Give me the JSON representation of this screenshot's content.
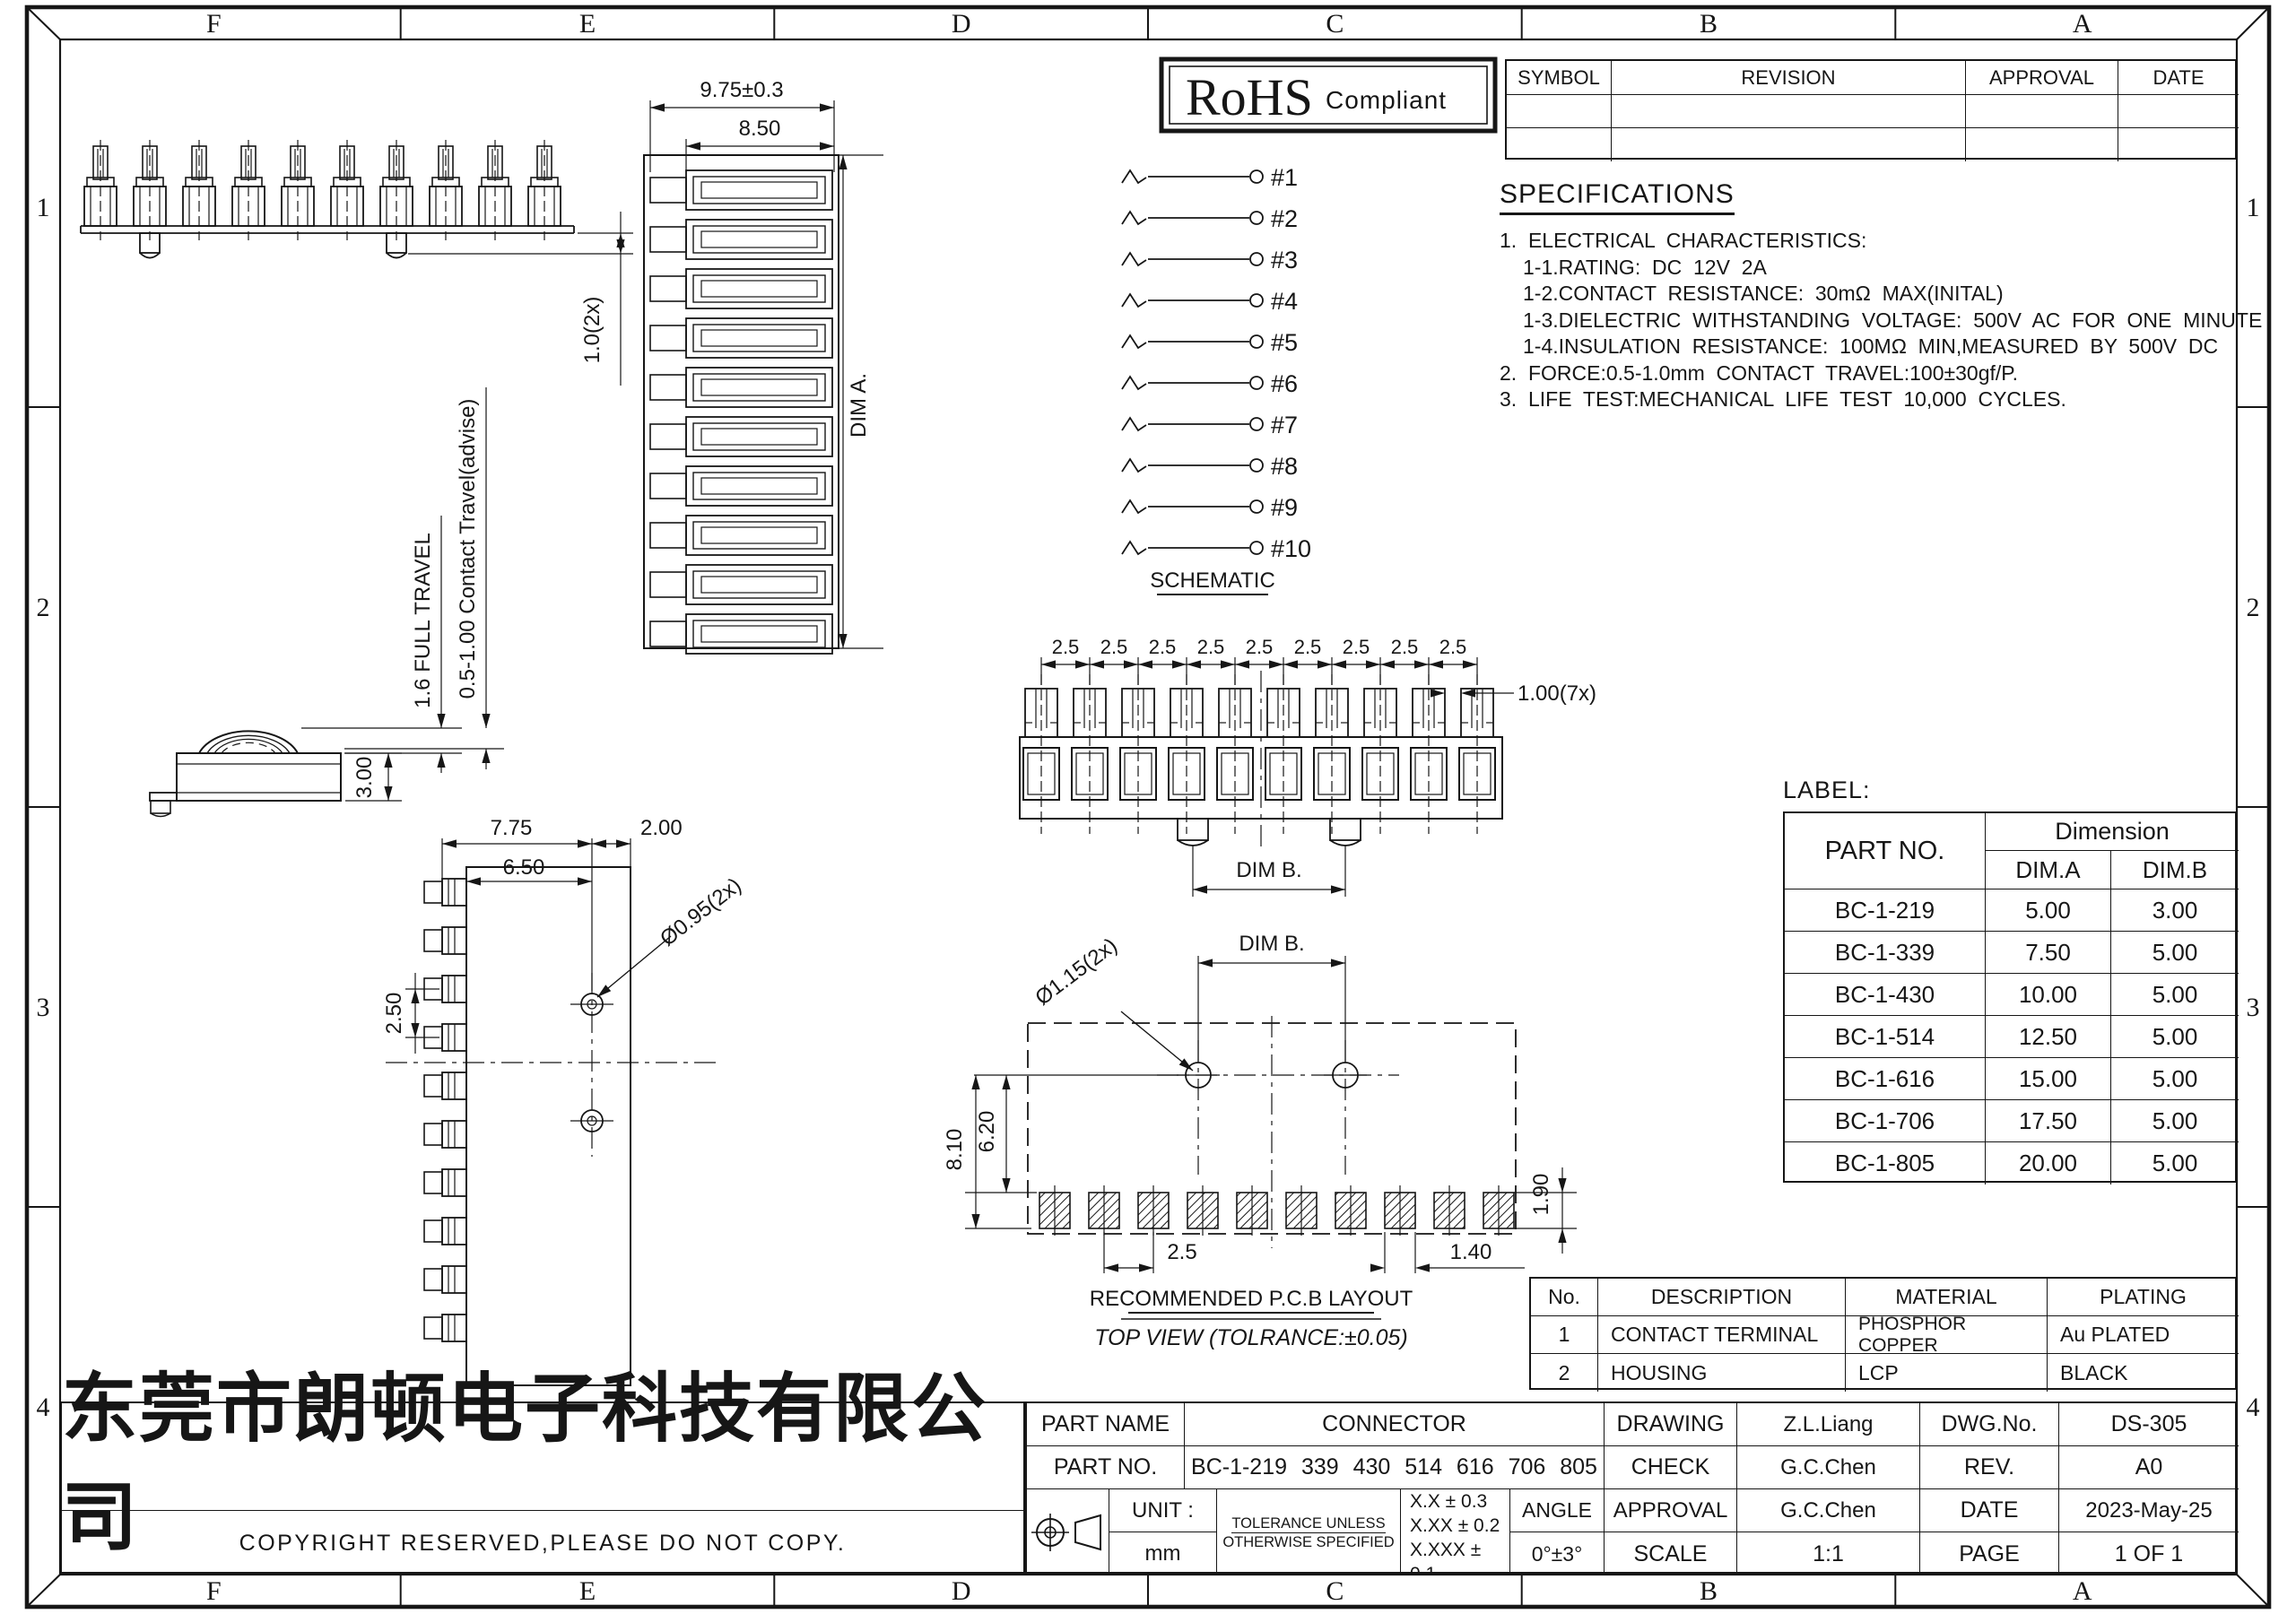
{
  "border": {
    "columns": [
      "F",
      "E",
      "D",
      "C",
      "B",
      "A"
    ],
    "rows": [
      "1",
      "2",
      "3",
      "4"
    ]
  },
  "rohs": {
    "title": "RoHS",
    "subtitle": "Compliant"
  },
  "revision_table": {
    "headers": [
      "SYMBOL",
      "REVISION",
      "APPROVAL",
      "DATE"
    ]
  },
  "specifications": {
    "title": "SPECIFICATIONS",
    "lines": [
      {
        "text": "1.  ELECTRICAL  CHARACTERISTICS:",
        "indent": 0
      },
      {
        "text": "1-1.RATING:  DC  12V  2A",
        "indent": 1
      },
      {
        "text": "1-2.CONTACT  RESISTANCE:  30mΩ  MAX(INITAL)",
        "indent": 1
      },
      {
        "text": "1-3.DIELECTRIC  WITHSTANDING  VOLTAGE:  500V  AC  FOR  ONE  MINUTE",
        "indent": 1
      },
      {
        "text": "1-4.INSULATION  RESISTANCE:  100MΩ  MIN,MEASURED  BY  500V  DC",
        "indent": 1
      },
      {
        "text": "2.  FORCE:0.5-1.0mm  CONTACT  TRAVEL:100±30gf/P.",
        "indent": 0
      },
      {
        "text": "3.  LIFE  TEST:MECHANICAL  LIFE  TEST  10,000  CYCLES.",
        "indent": 0
      }
    ]
  },
  "schematic": {
    "caption": "SCHEMATIC",
    "pins": [
      "#1",
      "#2",
      "#3",
      "#4",
      "#5",
      "#6",
      "#7",
      "#8",
      "#9",
      "#10"
    ]
  },
  "views": {
    "front_row": {
      "dim_travel": "1.0(2x)"
    },
    "side_contact": {
      "dim_full_travel": "1.6 FULL TRAVEL",
      "dim_contact_travel": "0.5-1.00 Contact Travel(advise)",
      "dim_height": "3.00"
    },
    "top_view_left": {
      "dim_width": "7.75",
      "dim_width2": "6.50",
      "dim_right": "2.00",
      "dim_pitch": "2.50",
      "dim_hole": "Ø0.95(2x)"
    },
    "front_view_vertical": {
      "dim_w1": "9.75±0.3",
      "dim_w2": "8.50",
      "dim_a": "DIM A."
    },
    "front_view_center": {
      "pitch": "2.5",
      "dim_gap": "1.00(7x)",
      "dim_b": "DIM B."
    },
    "pcb_layout": {
      "dim_b": "DIM B.",
      "dim_hole": "Ø1.15(2x)",
      "dim_h1": "6.20",
      "dim_h2": "8.10",
      "dim_pad_h": "1.90",
      "dim_pitch": "2.5",
      "dim_pad_w": "1.40",
      "caption1": "RECOMMENDED P.C.B LAYOUT",
      "caption2": "TOP VIEW  (TOLRANCE:±0.05)"
    }
  },
  "label_table": {
    "title": "LABEL:",
    "part_no_header": "PART  NO.",
    "dimension_header": "Dimension",
    "dim_a_header": "DIM.A",
    "dim_b_header": "DIM.B",
    "rows": [
      [
        "BC-1-219",
        "5.00",
        "3.00"
      ],
      [
        "BC-1-339",
        "7.50",
        "5.00"
      ],
      [
        "BC-1-430",
        "10.00",
        "5.00"
      ],
      [
        "BC-1-514",
        "12.50",
        "5.00"
      ],
      [
        "BC-1-616",
        "15.00",
        "5.00"
      ],
      [
        "BC-1-706",
        "17.50",
        "5.00"
      ],
      [
        "BC-1-805",
        "20.00",
        "5.00"
      ]
    ]
  },
  "parts_table": {
    "headers": [
      "No.",
      "DESCRIPTION",
      "MATERIAL",
      "PLATING"
    ],
    "rows": [
      [
        "1",
        "CONTACT TERMINAL",
        "PHOSPHOR COPPER",
        "Au PLATED"
      ],
      [
        "2",
        "HOUSING",
        "LCP",
        "BLACK"
      ]
    ]
  },
  "title_block": {
    "part_name_label": "PART NAME",
    "part_name": "CONNECTOR",
    "part_no_label": "PART NO.",
    "part_no": "BC-1-219 339 430 514 616 706 805",
    "unit_label": "UNIT :",
    "unit_value": "mm",
    "tolerance_note1": "TOLERANCE UNLESS",
    "tolerance_note2": "OTHERWISE SPECIFIED",
    "tol1": "X.X ± 0.3",
    "tol2": "X.XX ± 0.2",
    "tol3": "X.XXX ± 0.1",
    "angle_label": "ANGLE",
    "angle_value": "0°±3°",
    "drawing_label": "DRAWING",
    "drawing_value": "Z.L.Liang",
    "check_label": "CHECK",
    "check_value": "G.C.Chen",
    "approval_label": "APPROVAL",
    "approval_value": "G.C.Chen",
    "scale_label": "SCALE",
    "scale_value": "1:1",
    "dwg_no_label": "DWG.No.",
    "dwg_no": "DS-305",
    "rev_label": "REV.",
    "rev": "A0",
    "date_label": "DATE",
    "date": "2023-May-25",
    "page_label": "PAGE",
    "page": "1 OF 1"
  },
  "company": {
    "name": "东莞市朗顿电子科技有限公司",
    "copyright": "COPYRIGHT RESERVED,PLEASE DO NOT COPY."
  }
}
